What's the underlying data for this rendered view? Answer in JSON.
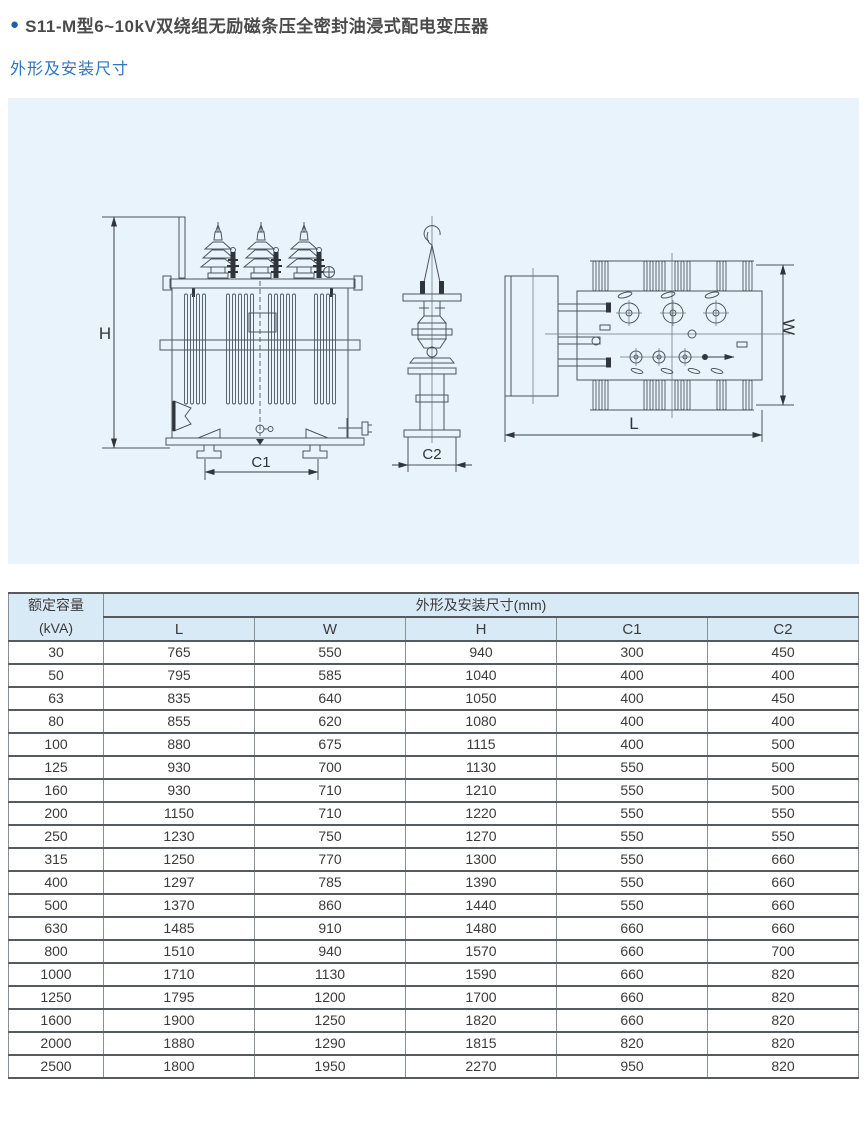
{
  "page": {
    "bullet": "●",
    "title": "S11-M型6~10kV双绕组无励磁条压全密封油浸式配电变压器",
    "subtitle": "外形及安装尺寸"
  },
  "colors": {
    "accent_blue": "#1b5fae",
    "subtitle_blue": "#2f74c0",
    "panel_bg": "#e8f3fb",
    "table_header_bg": "#d9eaf7",
    "line_color": "#4d565e"
  },
  "drawing": {
    "labels": {
      "h": "H",
      "c1": "C1",
      "c2": "C2",
      "l": "L",
      "w": "W"
    }
  },
  "table": {
    "header": {
      "capacity": "额定容量",
      "capacity_unit": "(kVA)",
      "group": "外形及安装尺寸(mm)",
      "columns": [
        "L",
        "W",
        "H",
        "C1",
        "C2"
      ]
    },
    "rows": [
      [
        "30",
        "765",
        "550",
        "940",
        "300",
        "450"
      ],
      [
        "50",
        "795",
        "585",
        "1040",
        "400",
        "400"
      ],
      [
        "63",
        "835",
        "640",
        "1050",
        "400",
        "450"
      ],
      [
        "80",
        "855",
        "620",
        "1080",
        "400",
        "400"
      ],
      [
        "100",
        "880",
        "675",
        "1115",
        "400",
        "500"
      ],
      [
        "125",
        "930",
        "700",
        "1130",
        "550",
        "500"
      ],
      [
        "160",
        "930",
        "710",
        "1210",
        "550",
        "500"
      ],
      [
        "200",
        "1150",
        "710",
        "1220",
        "550",
        "550"
      ],
      [
        "250",
        "1230",
        "750",
        "1270",
        "550",
        "550"
      ],
      [
        "315",
        "1250",
        "770",
        "1300",
        "550",
        "660"
      ],
      [
        "400",
        "1297",
        "785",
        "1390",
        "550",
        "660"
      ],
      [
        "500",
        "1370",
        "860",
        "1440",
        "550",
        "660"
      ],
      [
        "630",
        "1485",
        "910",
        "1480",
        "660",
        "660"
      ],
      [
        "800",
        "1510",
        "940",
        "1570",
        "660",
        "700"
      ],
      [
        "1000",
        "1710",
        "1130",
        "1590",
        "660",
        "820"
      ],
      [
        "1250",
        "1795",
        "1200",
        "1700",
        "660",
        "820"
      ],
      [
        "1600",
        "1900",
        "1250",
        "1820",
        "660",
        "820"
      ],
      [
        "2000",
        "1880",
        "1290",
        "1815",
        "820",
        "820"
      ],
      [
        "2500",
        "1800",
        "1950",
        "2270",
        "950",
        "820"
      ]
    ]
  }
}
